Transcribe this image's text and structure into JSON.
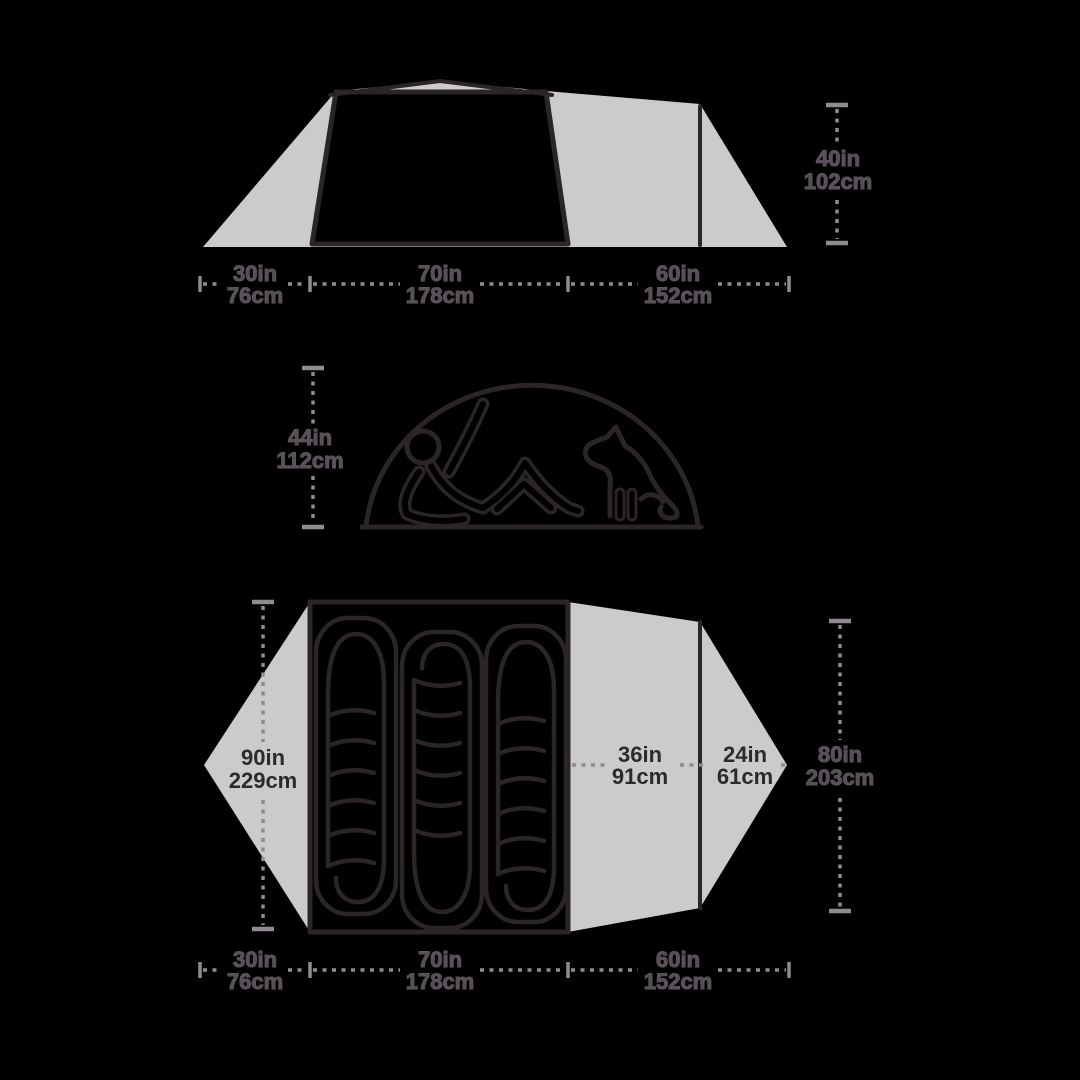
{
  "colors": {
    "background": "#000000",
    "silhouette_gray": "#cbcbcb",
    "outline_dark": "#2b2428",
    "dimension_gray": "#8f8b91",
    "label_on_gray": "#2d2a2d",
    "label_on_black": "#594f59"
  },
  "icons": {
    "person": "reclining-person-icon",
    "dog": "sitting-dog-icon"
  },
  "diagrams": {
    "side_view": {
      "base_segments": [
        {
          "inches": "30in",
          "cm": "76cm"
        },
        {
          "inches": "70in",
          "cm": "178cm"
        },
        {
          "inches": "60in",
          "cm": "152cm"
        }
      ],
      "height": {
        "inches": "40in",
        "cm": "102cm"
      }
    },
    "interior": {
      "peak_height": {
        "inches": "44in",
        "cm": "112cm"
      }
    },
    "floor": {
      "length": {
        "inches": "90in",
        "cm": "229cm"
      },
      "inner_width": {
        "inches": "36in",
        "cm": "91cm"
      },
      "vestibule_depth": {
        "inches": "24in",
        "cm": "61cm"
      },
      "total_width": {
        "inches": "80in",
        "cm": "203cm"
      },
      "base_segments": [
        {
          "inches": "30in",
          "cm": "76cm"
        },
        {
          "inches": "70in",
          "cm": "178cm"
        },
        {
          "inches": "60in",
          "cm": "152cm"
        }
      ]
    }
  }
}
